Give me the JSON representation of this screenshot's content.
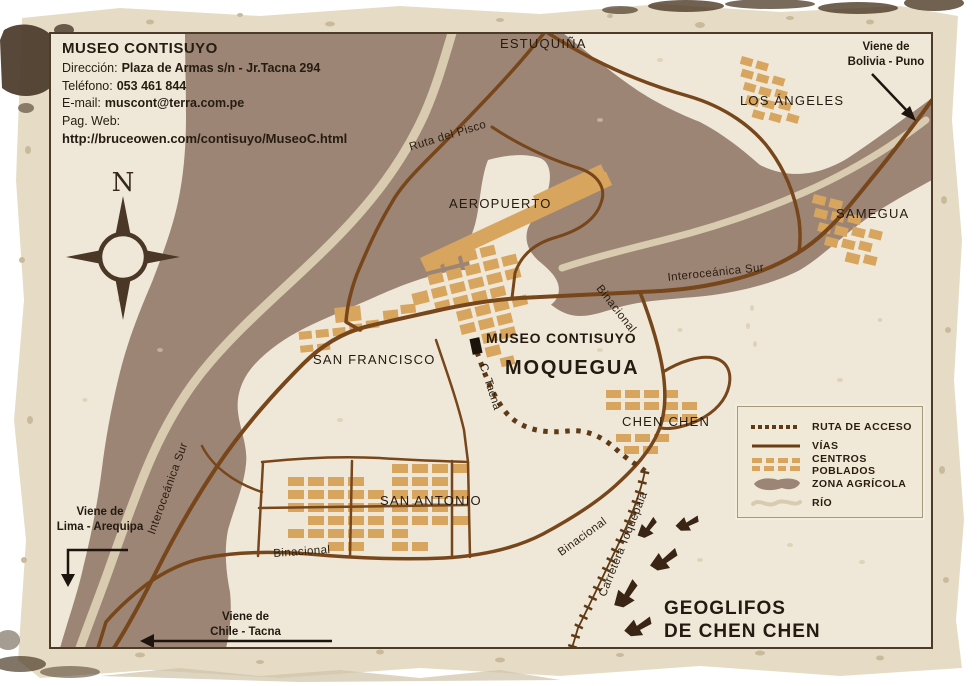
{
  "colors": {
    "paper": "#e6dcc6",
    "map_background": "#efe8d8",
    "agricultural_zone": "#9c8575",
    "river": "#d8cbb0",
    "road": "#77461a",
    "settlement": "#d8a55e",
    "ink": "#241a10"
  },
  "info_box": {
    "title": "MUSEO CONTISUYO",
    "address_label": "Dirección:",
    "address": "Plaza de Armas s/n - Jr.Tacna 294",
    "phone_label": "Teléfono:",
    "phone": "053 461 844",
    "email_label": "E-mail:",
    "email": "muscont@terra.com.pe",
    "web_label": "Pag. Web:",
    "web_url": "http://bruceowen.com/contisuyo/MuseoC.html"
  },
  "compass": {
    "north": "N"
  },
  "places": {
    "estuquina": "ESTUQUIÑA",
    "los_angeles": "LOS ÁNGELES",
    "aeropuerto": "AEROPUERTO",
    "samegua": "SAMEGUA",
    "san_francisco": "SAN FRANCISCO",
    "museo": "MUSEO CONTISUYO",
    "moquegua": "MOQUEGUA",
    "chen_chen": "CHEN CHEN",
    "san_antonio": "SAN ANTONIO",
    "geoglifos_line1": "GEOGLIFOS",
    "geoglifos_line2": "DE CHEN CHEN"
  },
  "roads": {
    "ruta_del_pisco": "Ruta del Pisco",
    "interoceanica_sur_ne": "Interoceánica Sur",
    "interoceanica_sur_sw": "Interoceánica Sur",
    "binacional_ne": "Binacional",
    "binacional_sw": "Binacional",
    "binacional_se": "Binacional",
    "c_tacna": "C. Tacna",
    "carretera_toquepala": "Carretera Toquepala"
  },
  "directions": {
    "bolivia_line1": "Viene de",
    "bolivia_line2": "Bolivia - Puno",
    "lima_line1": "Viene de",
    "lima_line2": "Lima - Arequipa",
    "chile_line1": "Viene de",
    "chile_line2": "Chile - Tacna"
  },
  "legend": {
    "items": [
      {
        "label": "RUTA DE ACCESO",
        "symbol": "dotted-route"
      },
      {
        "label": "VÍAS",
        "symbol": "road-line"
      },
      {
        "label": "CENTROS POBLADOS",
        "symbol": "settlement-blocks"
      },
      {
        "label": "ZONA AGRÍCOLA",
        "symbol": "agricultural-blob"
      },
      {
        "label": "RÍO",
        "symbol": "river-line"
      }
    ]
  }
}
